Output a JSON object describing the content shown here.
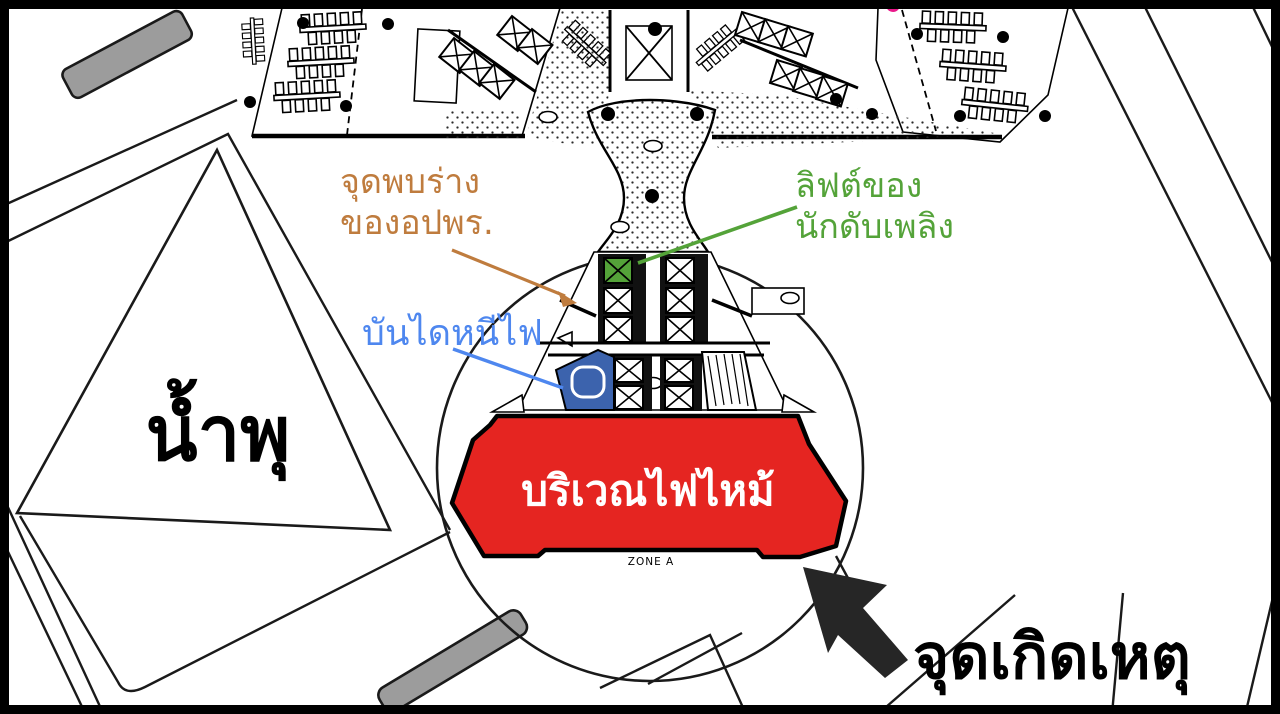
{
  "title": "Fire incident annotated floor plan",
  "labels": {
    "body_found_line1": "จุดพบร่าง",
    "body_found_line2": "ของอปพร.",
    "firefighter_lift_line1": "ลิฟต์ของ",
    "firefighter_lift_line2": "นักดับเพลิง",
    "fire_escape_stairs": "บันไดหนีไฟ",
    "fountain": "น้ำพุ",
    "fire_area": "บริเวณไฟไหม้",
    "zone": "ZONE A",
    "incident_point": "จุดเกิดเหตุ"
  },
  "colors": {
    "body_found_label": "#bf7c3e",
    "firefighter_lift_label": "#54a339",
    "fire_escape_label": "#4e87ef",
    "fire_area_fill": "#e52521",
    "fire_area_text": "#ffffff",
    "stairwell_fill": "#3c63ad",
    "gray_structure": "#9c9c9c",
    "magenta_marker": "#e9188a",
    "ink": "#000000"
  }
}
